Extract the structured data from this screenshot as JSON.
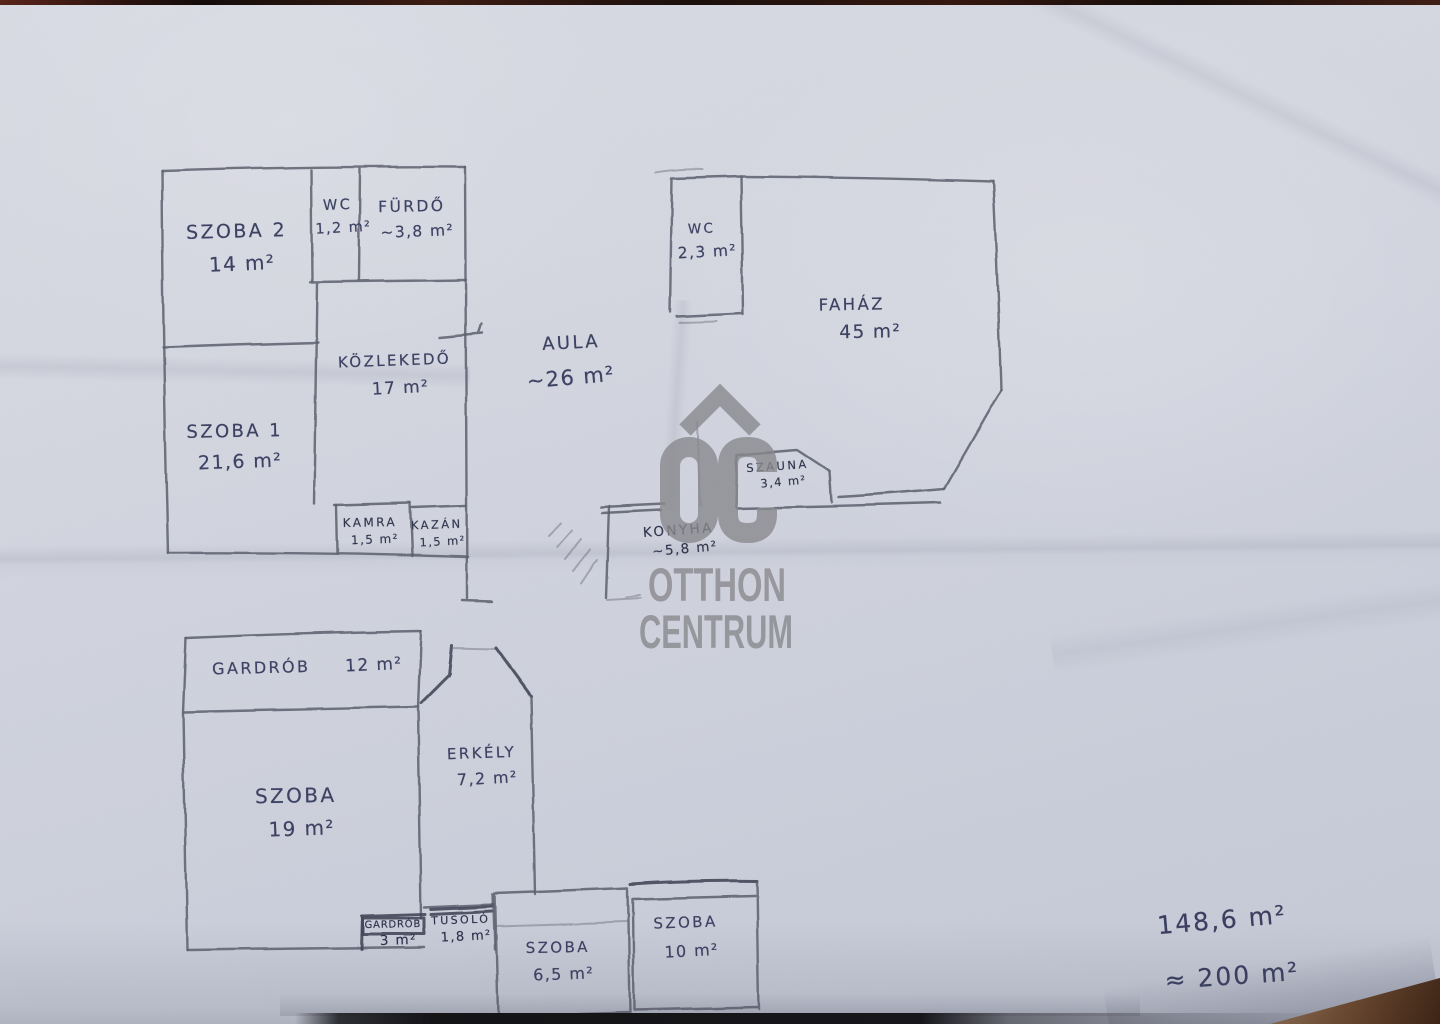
{
  "document": {
    "kind": "hand-drawn floor plan sketch (photo)",
    "language": "Hungarian",
    "paper_color": "#d2d5df",
    "pencil_color": "#5c5f6c",
    "handwriting_color": "#3d4263"
  },
  "watermark": {
    "monogram": "OC",
    "line1": "OTTHON",
    "line2": "CENTRUM",
    "color": "#8a8a8f"
  },
  "rooms": [
    {
      "id": "szoba2",
      "name": "SZOBA 2",
      "area": "14 m²"
    },
    {
      "id": "wc1",
      "name": "WC",
      "area": "1,2 m²"
    },
    {
      "id": "furdo",
      "name": "FÜRDŐ",
      "area": "~3,8 m²"
    },
    {
      "id": "kozlekedo",
      "name": "KÖZLEKEDŐ",
      "area": "17 m²"
    },
    {
      "id": "szoba1",
      "name": "SZOBA 1",
      "area": "21,6 m²"
    },
    {
      "id": "kamra",
      "name": "KAMRA",
      "area": "1,5 m²"
    },
    {
      "id": "kazan",
      "name": "KAZÁN",
      "area": "1,5 m²"
    },
    {
      "id": "aula",
      "name": "AULA",
      "area": "~26 m²"
    },
    {
      "id": "wc2",
      "name": "WC",
      "area": "2,3 m²"
    },
    {
      "id": "fahaz",
      "name": "FAHÁZ",
      "area": "45 m²"
    },
    {
      "id": "szauna",
      "name": "SZAUNA",
      "area": "3,4 m²"
    },
    {
      "id": "konyha",
      "name": "KONYHA",
      "area": "~5,8 m²"
    },
    {
      "id": "gardrob12",
      "name": "GARDRÓB",
      "area": "12 m²"
    },
    {
      "id": "szoba19",
      "name": "SZOBA",
      "area": "19 m²"
    },
    {
      "id": "erkely",
      "name": "ERKÉLY",
      "area": "7,2 m²"
    },
    {
      "id": "gardrob3",
      "name": "GARDRÓB",
      "area": "3 m²"
    },
    {
      "id": "tusolo",
      "name": "TUSOLÓ",
      "area": "1,8 m²"
    },
    {
      "id": "szoba65",
      "name": "SZOBA",
      "area": "6,5 m²"
    },
    {
      "id": "szoba10",
      "name": "SZOBA",
      "area": "10 m²"
    }
  ],
  "totals": {
    "exact": "148,6 m²",
    "approx": "≈ 200 m²"
  }
}
